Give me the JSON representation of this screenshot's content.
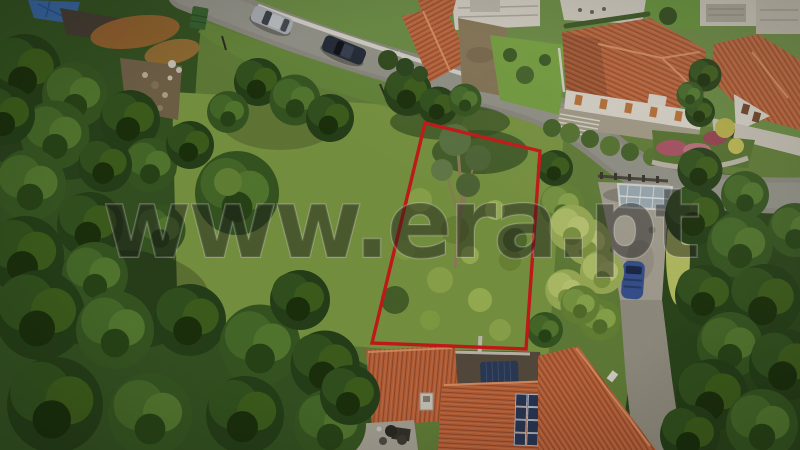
{
  "watermark": {
    "text": "www.era.pt"
  },
  "plot_boundary": {
    "shape": "quadrilateral",
    "stroke_color": "#db1d1d"
  },
  "counts": {
    "cars_on_road": 2,
    "solar_panels": 8
  },
  "colors": {
    "boundary_red": "#db1d1d",
    "watermark_ink": "#1e1e1e",
    "roof_orange": "#c96a3e",
    "roof_tile_dark": "#a2502c",
    "roof_ridge": "#edA06e",
    "road_gray": "#98968b",
    "wall_white": "#ebe8df",
    "driveway_gray": "#b3ae9f",
    "glass_canopy_blue": "#a9bac3",
    "solar_panel_blue": "#2d3b5a",
    "vehicle_blue": "#3c589c",
    "car_silver": "#b8bcc1",
    "car_dark": "#262e3d",
    "tarp_blue": "#31405e",
    "container_green": "#3c6a34",
    "forest_dark": "#2a461b",
    "forest_mid": "#3a5a26",
    "shrub_green": "#85a348",
    "stone_wall": "#b2a995"
  }
}
